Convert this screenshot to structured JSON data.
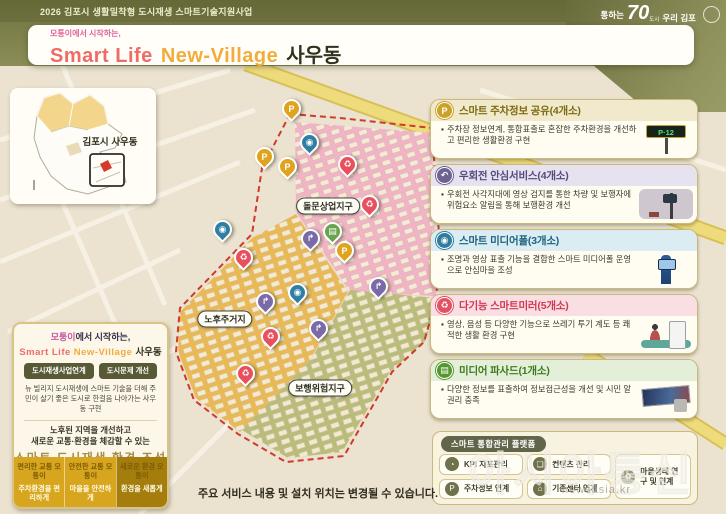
{
  "palette": {
    "band_olive": "#7b7d4c",
    "map_beige": "#ebe2d0",
    "road_yellow": "#eedc7c",
    "boundary_red": "#cf3a2b",
    "zone_pink": "#f2b3c9",
    "zone_orange": "#eab954",
    "zone_olive": "#b9bd7b",
    "gold": "#d7a61e"
  },
  "header": {
    "program_title": "2026 김포시 생활밀착형 도시재생 스마트기술지원사업",
    "logo": {
      "prefix": "통하는",
      "number": "70",
      "inner": "도시",
      "suffix": "우리 김포"
    }
  },
  "title_card": {
    "subtitle": "모퉁이에서 시작하는,",
    "title_en_1": "Smart Life",
    "title_en_2": "New-Village",
    "title_ko": "사우동"
  },
  "region_card": {
    "label": "김포시 사우동"
  },
  "map": {
    "zone_labels": [
      {
        "name": "돌문상업지구",
        "x": 328,
        "y": 206
      },
      {
        "name": "노후주거지",
        "x": 225,
        "y": 319
      },
      {
        "name": "보행위험지구",
        "x": 320,
        "y": 388
      }
    ],
    "pin_types": {
      "parking": {
        "glyph": "P",
        "color": "#dfa31d",
        "name": "parking-pin"
      },
      "right_turn": {
        "glyph": "↱",
        "color": "#7a6aa8",
        "name": "right-turn-pin"
      },
      "media_pole": {
        "glyph": "◉",
        "color": "#2f7fa3",
        "name": "media-pole-pin"
      },
      "mirror": {
        "glyph": "♻",
        "color": "#e8505e",
        "name": "smart-mirror-pin"
      },
      "facade": {
        "glyph": "▤",
        "color": "#6aa34e",
        "name": "media-facade-pin"
      }
    },
    "pins": [
      {
        "type": "parking",
        "x": 291,
        "y": 122
      },
      {
        "type": "parking",
        "x": 264,
        "y": 170
      },
      {
        "type": "parking",
        "x": 287,
        "y": 180
      },
      {
        "type": "parking",
        "x": 344,
        "y": 264
      },
      {
        "type": "media_pole",
        "x": 309,
        "y": 156
      },
      {
        "type": "media_pole",
        "x": 222,
        "y": 243
      },
      {
        "type": "media_pole",
        "x": 297,
        "y": 306
      },
      {
        "type": "mirror",
        "x": 347,
        "y": 178
      },
      {
        "type": "mirror",
        "x": 369,
        "y": 218
      },
      {
        "type": "mirror",
        "x": 243,
        "y": 271
      },
      {
        "type": "mirror",
        "x": 270,
        "y": 350
      },
      {
        "type": "mirror",
        "x": 245,
        "y": 387
      },
      {
        "type": "right_turn",
        "x": 310,
        "y": 252
      },
      {
        "type": "right_turn",
        "x": 265,
        "y": 315
      },
      {
        "type": "right_turn",
        "x": 318,
        "y": 342
      },
      {
        "type": "right_turn",
        "x": 378,
        "y": 300
      },
      {
        "type": "facade",
        "x": 332,
        "y": 245
      }
    ]
  },
  "service_cards": [
    {
      "title": "스마트 주차정보 공유(4개소)",
      "desc": "주차장 정보연계, 통합표출로 혼잡한 주차환경을 개선하고 편리한 생활환경 구현",
      "icon_glyph": "P",
      "icon_name": "parking-icon",
      "color": "#c9a227",
      "title_color": "#7e6a10",
      "strip": "#f1e9cb",
      "art": "parking"
    },
    {
      "title": "우회전 안심서비스(4개소)",
      "desc": "우회전 사각지대에 영상 검지를 통한 차량 및 보행자에 위험요소 알림을 통해 보행환경 개선",
      "icon_glyph": "↶",
      "icon_name": "right-turn-arrow-icon",
      "color": "#6e6292",
      "title_color": "#554a7e",
      "strip": "#e7e2ef",
      "art": "cctv"
    },
    {
      "title": "스마트 미디어폴(3개소)",
      "desc": "조명과 영상 표출 기능을 결합한 스마트 미디어폴 운영으로 안심마을 조성",
      "icon_glyph": "◉",
      "icon_name": "cctv-icon",
      "color": "#2e7d9e",
      "title_color": "#1a647f",
      "strip": "#dcecf3",
      "art": "pole"
    },
    {
      "title": "다기능 스마트미러(5개소)",
      "desc": "영상, 음성 등 다양한 기능으로 쓰레기 투기 계도 등 쾌적한 생활 환경 구현",
      "icon_glyph": "♻",
      "icon_name": "trash-bin-icon",
      "color": "#e05264",
      "title_color": "#cf3950",
      "strip": "#f9dfe3",
      "art": "mirror"
    },
    {
      "title": "미디어 파사드(1개소)",
      "desc": "다양한 정보를 표출하여 정보접근성을 개선 및 시민 알권리 충족",
      "icon_glyph": "▤",
      "icon_name": "screen-icon",
      "color": "#56962f",
      "title_color": "#3e7c1d",
      "strip": "#e3efd9",
      "art": "facade"
    }
  ],
  "vision": {
    "subtitle_highlight": "모퉁이",
    "subtitle_rest": "에서 시작하는,",
    "title_en_1": "Smart Life",
    "title_en_2": "New-Village",
    "title_ko": "사우동",
    "buttons": [
      "도시재생사업연계",
      "도시문제 개선"
    ],
    "paragraph": "뉴 빌리지 도시재생에 스마트 기술을 더해 주민이 살기 좋은 도시로 한걸음 나아가는 사우동 구현",
    "goal_line1": "노후된 지역을 개선하고",
    "goal_line2": "새로운 교통·환경을 체감할 수 있는",
    "goal_title": "스마트 도시재생 환경 조성",
    "tiles": [
      {
        "top": "편리한 교통 모퉁이",
        "bottom": "주차환경을 편리하게",
        "bg": "#d7a61e"
      },
      {
        "top": "안전한 교통 모퉁이",
        "bottom": "마을을 안전하게",
        "bg": "#d7a61e"
      },
      {
        "top": "새로운 환경 모퉁이",
        "bottom": "환경을 새롭게",
        "bg": "#a47d0d"
      }
    ]
  },
  "platform": {
    "title": "스마트 통합관리 플랫폼",
    "items": [
      {
        "label": "KPI 지표관리",
        "icon_glyph": "◔",
        "icon_name": "gauge-icon",
        "tall": false
      },
      {
        "label": "컨텐츠 관리",
        "icon_glyph": "❏",
        "icon_name": "folder-icon",
        "tall": false
      },
      {
        "label": "주차정보 연계",
        "icon_glyph": "P",
        "icon_name": "car-icon",
        "tall": false
      },
      {
        "label": "기존센터 연계",
        "icon_glyph": "⌂",
        "icon_name": "building-icon",
        "tall": false
      },
      {
        "label": "마을생태 연구 및 연계",
        "icon_glyph": "✿",
        "icon_name": "leaf-icon",
        "tall": true
      }
    ]
  },
  "footer_note": "주요 서비스 내용 및 설치 위치는 변경될 수 있습니다.",
  "watermark": {
    "agency": "아시아통신",
    "url": "newsasia.kr"
  }
}
